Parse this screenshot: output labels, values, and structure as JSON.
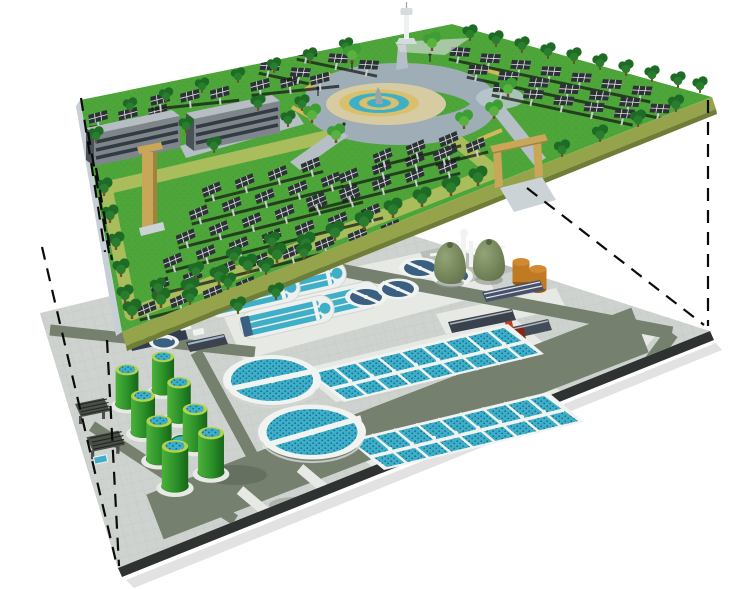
{
  "scene": {
    "type": "exploded-view architectural illustration",
    "upper_level": {
      "name": "ground-level eco park",
      "components": [
        "solar panel arrays",
        "trees",
        "two office buildings",
        "circular plaza with tiered fountain",
        "ring road",
        "observation tower",
        "gateway arches",
        "perimeter walking path"
      ]
    },
    "lower_level": {
      "name": "underground wastewater treatment plant",
      "components": [
        "green sludge digester tanks",
        "two large secondary clarifiers with bridges",
        "oxidation ditches",
        "small clarifiers",
        "two aeration basin blocks with finger piers",
        "two egg-shaped digesters",
        "two orange storage tanks",
        "service buildings",
        "red pump unit",
        "inlet screen structures",
        "service roads"
      ]
    },
    "connection": "black dashed projection lines linking upper platform corners to lower platform corners"
  },
  "counts": {
    "green_digester_tanks": 8,
    "large_clarifiers": 2,
    "small_clarifiers": 4,
    "oxidation_ditches": 4,
    "aeration_basin_blocks": 2,
    "egg_digesters": 2,
    "orange_storage_tanks": 2,
    "park_buildings": 2,
    "gateway_arches": 2,
    "projection_lines": 7
  },
  "colors": {
    "grass": "#4ea53a",
    "rim": "#a9bd5c",
    "slabSide": "#95a44b",
    "slabSideDark": "#6f7d36",
    "slabWest": "#c6cfd6",
    "treeDark": "#1e6b26",
    "treeDark2": "#2a7d2e",
    "treeLight": "#3f9d35",
    "trunk": "#7a4c22",
    "panel": "#2b3134",
    "panelGrid": "#dfe3e3",
    "post": "#c9cfcf",
    "rowShadow": "#151d15",
    "bldgWall": "#7e868c",
    "bldgDark": "#4a5258",
    "bldgRoof": "#b7bdc2",
    "bldgWin": "#333b42",
    "plazaRing": "#9fadb6",
    "plazaTan": "#d7cba2",
    "fountainTan": "#d9c06c",
    "water": "#3fafc8",
    "waterDark": "#1b85a8",
    "stone": "#9aa3a8",
    "wallTan": "#d2b85a",
    "pathGray": "#b6bfc5",
    "pond": "#b9c8ce",
    "towerGray": "#d6dbdd",
    "gateTan": "#c9a758",
    "gateTanDark": "#a2823e",
    "rampGray": "#ccd3d7",
    "lowerPaving": "#ced3cf",
    "tileLine": "#c2c7c2",
    "lowerSide": "#2e3331",
    "lowerSideL": "#9aa09a",
    "road": "#76806f",
    "pad": "#e7e9e5",
    "padGray": "#b9beb9",
    "tankRim": "#b5d24b",
    "clarWhite": "#f1f3f1",
    "clarRim": "#d2d7d2",
    "basinBlue": "#2a96bd",
    "basinDot": "#146f96",
    "ditchWhite": "#eef0ed",
    "navy": "#3b5f80",
    "eggOlive": "#74855c",
    "eggDark": "#55663f",
    "orange": "#c07a22",
    "orangeTop": "#d18a33",
    "orangeDark": "#95590f",
    "red": "#c23b1f",
    "redDark": "#8c2511",
    "grate": "#4a4f49",
    "dash": "#0b0b0b"
  }
}
